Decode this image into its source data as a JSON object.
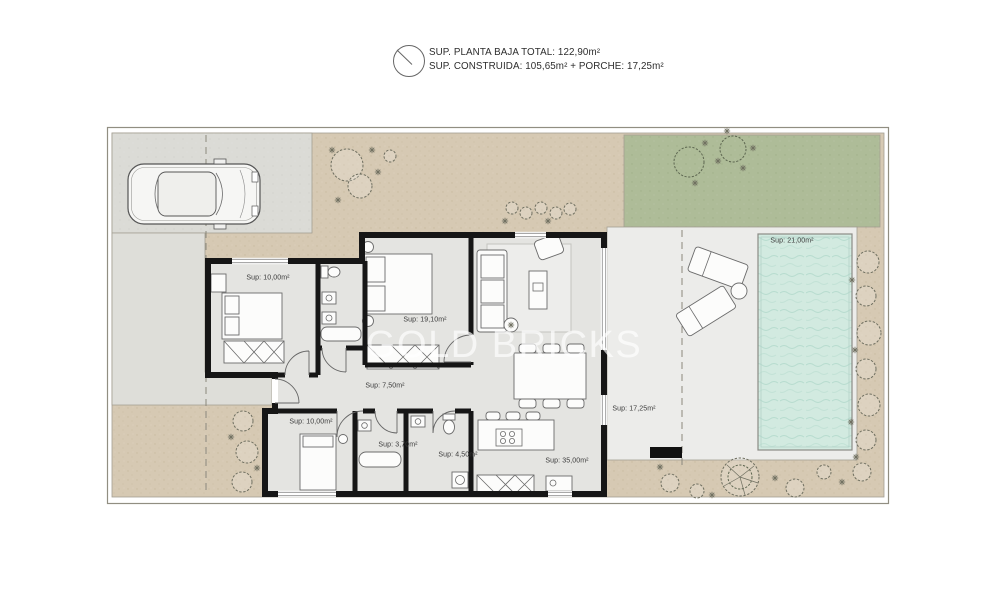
{
  "header": {
    "line1": "SUP. PLANTA BAJA TOTAL: 122,90m²",
    "line2": "SUP. CONSTRUIDA: 105,65m² + PORCHE: 17,25m²"
  },
  "watermark": "GOLD BRICKS",
  "rooms": {
    "bedroom_top_left": "Sup: 10,00m²",
    "bedroom_master": "Sup: 19,10m²",
    "hallway": "Sup: 7,50m²",
    "bedroom_bottom": "Sup: 10,00m²",
    "bathroom_small": "Sup: 3,70m²",
    "bathroom_large": "Sup: 4,50m²",
    "living_kitchen": "Sup: 35,00m²",
    "porch": "Sup: 17,25m²",
    "pool": "Sup: 21,00m²"
  },
  "icons": {
    "compass": "north-indicator-circle"
  },
  "colors": {
    "ground_beige": "#d6c9b3",
    "lawn_green": "#aebc98",
    "driveway_gray": "#dbdbd6",
    "terrace_gray": "#ececea",
    "floor_gray": "#e4e4e1",
    "pool_teal": "#d2eae0",
    "wall_black": "#161616"
  }
}
